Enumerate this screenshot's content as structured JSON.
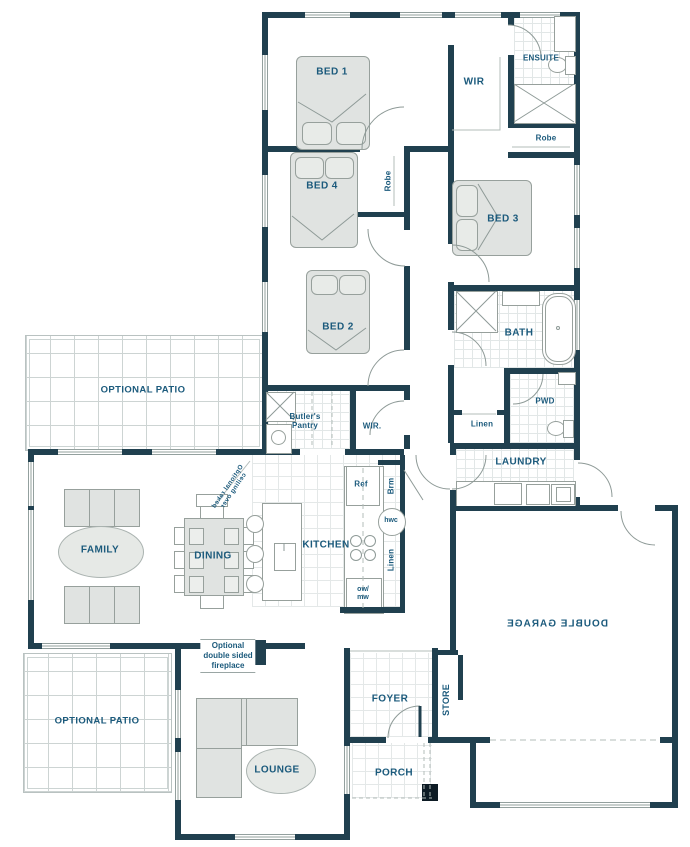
{
  "plan": {
    "type": "residential-floor-plan",
    "colors": {
      "wall": "#20404f",
      "label_text": "#1b5a7c",
      "furniture_fill": "#e0e3e1",
      "line_gray": "#9aa6a4",
      "tile_grid": "#e2e7e7",
      "patio_grid": "#cdd4d3"
    },
    "labels": {
      "bed1": "BED 1",
      "bed2": "BED 2",
      "bed3": "BED 3",
      "bed4": "BED 4",
      "wir_master": "WIR",
      "wir_hall": "WIR.",
      "ensuite": "ENSUITE",
      "robe_ensuite": "Robe",
      "robe_bed4": "Robe",
      "bath": "BATH",
      "pwd": "PWD",
      "linen_hall": "Linen",
      "linen_kitchen": "Linen",
      "laundry": "LAUNDRY",
      "butlers_line1": "Butler's",
      "butlers_line2": "Pantry",
      "ref": "Ref",
      "brm": "Brm",
      "hwc": "hwc",
      "owmw_line1": "ow/",
      "owmw_line2": "mw",
      "kitchen": "KITCHEN",
      "dining": "DINING",
      "family": "FAMILY",
      "patio_top": "OPTIONAL PATIO",
      "patio_bottom": "OPTIONAL PATIO",
      "fireplace_line1": "Optional",
      "fireplace_line2": "double sided",
      "fireplace_line3": "fireplace",
      "raked_line1": "Optional raked",
      "raked_line2": "ceiling over",
      "lounge": "LOUNGE",
      "foyer": "FOYER",
      "porch": "PORCH",
      "store": "STORE",
      "garage": "DOUBLE GARAGE"
    },
    "mirrored_labels": [
      "garage",
      "raked_line1",
      "raked_line2"
    ],
    "vertical_labels": [
      "store",
      "brm",
      "linen_kitchen",
      "robe_bed4"
    ]
  }
}
